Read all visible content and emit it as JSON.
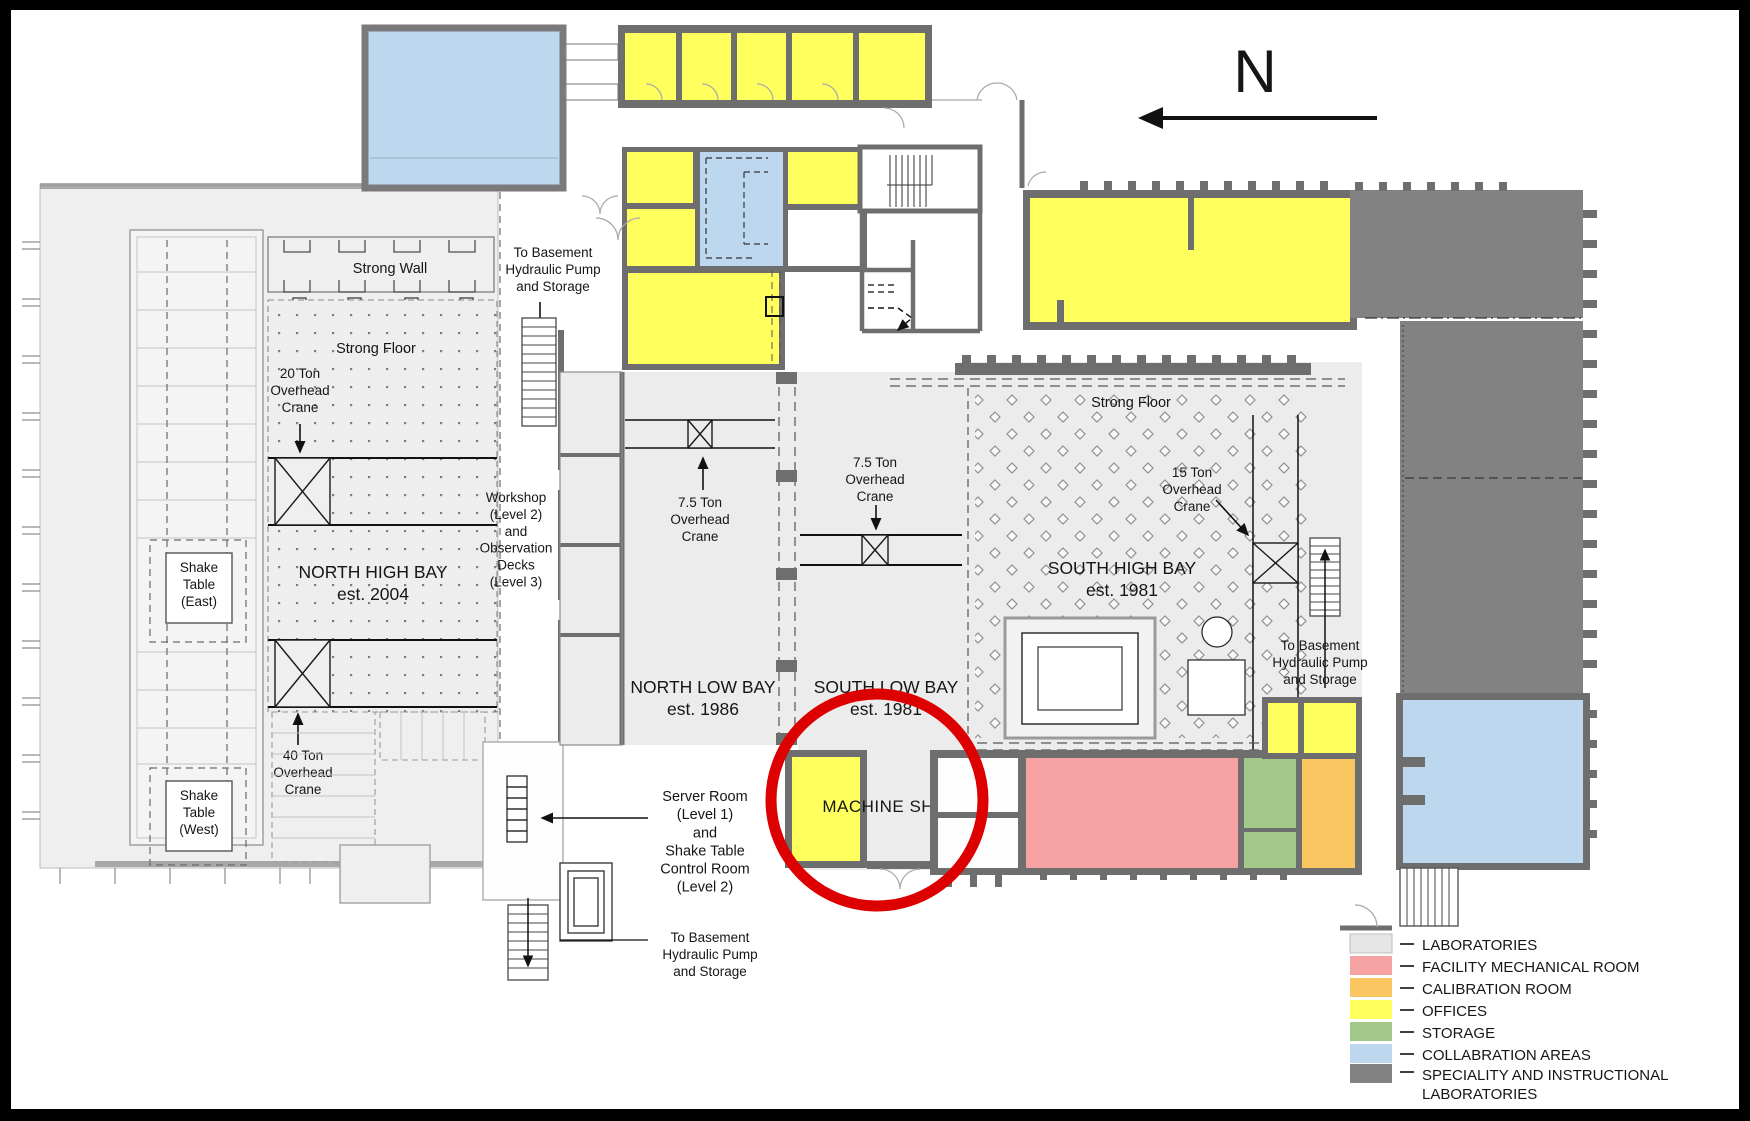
{
  "title": "Laboratory facility floor plan",
  "compass": {
    "label": "N"
  },
  "labels": {
    "strong_wall": "Strong Wall",
    "strong_floor_north": "Strong Floor",
    "crane_20t": "20 Ton\nOverhead\nCrane",
    "shake_table_east": "Shake\nTable\n(East)",
    "north_high_bay": "NORTH HIGH BAY\nest. 2004",
    "crane_40t": "40 Ton\nOverhead\nCrane",
    "shake_table_west": "Shake\nTable\n(West)",
    "workshop": "Workshop\n(Level 2)\nand\nObservation\nDecks\n(Level 3)",
    "to_basement_top": "To Basement\nHydraulic Pump\nand Storage",
    "crane_75t_north": "7.5 Ton\nOverhead\nCrane",
    "crane_75t_south": "7.5 Ton\nOverhead\nCrane",
    "north_low_bay": "NORTH LOW BAY\nest. 1986",
    "south_low_bay": "SOUTH LOW BAY\nest. 1981",
    "server_room": "Server Room\n(Level 1)\nand\nShake Table\nControl Room\n(Level 2)",
    "to_basement_bottom": "To Basement\nHydraulic Pump\nand Storage",
    "machine_shop": "MACHINE SHOP",
    "strong_floor_south": "Strong Floor",
    "south_high_bay": "SOUTH HIGH BAY\nest. 1981",
    "crane_15t": "15 Ton\nOverhead\nCrane",
    "to_basement_right": "To Basement\nHydraulic Pump\nand Storage"
  },
  "legend": {
    "items": [
      {
        "label": "LABORATORIES",
        "color": "#e6e6e6"
      },
      {
        "label": "FACILITY MECHANICAL ROOM",
        "color": "#f7a2a2"
      },
      {
        "label": "CALIBRATION ROOM",
        "color": "#f9c661"
      },
      {
        "label": "OFFICES",
        "color": "#ffff5e"
      },
      {
        "label": "STORAGE",
        "color": "#a2c88a"
      },
      {
        "label": "COLLABRATION AREAS",
        "color": "#bdd7ee"
      },
      {
        "label": "SPECIALITY AND INSTRUCTIONAL\nLABORATORIES",
        "color": "#828282"
      }
    ]
  },
  "annotation": {
    "highlight_color": "#dd0000",
    "highlighted_room": "MACHINE SHOP"
  }
}
